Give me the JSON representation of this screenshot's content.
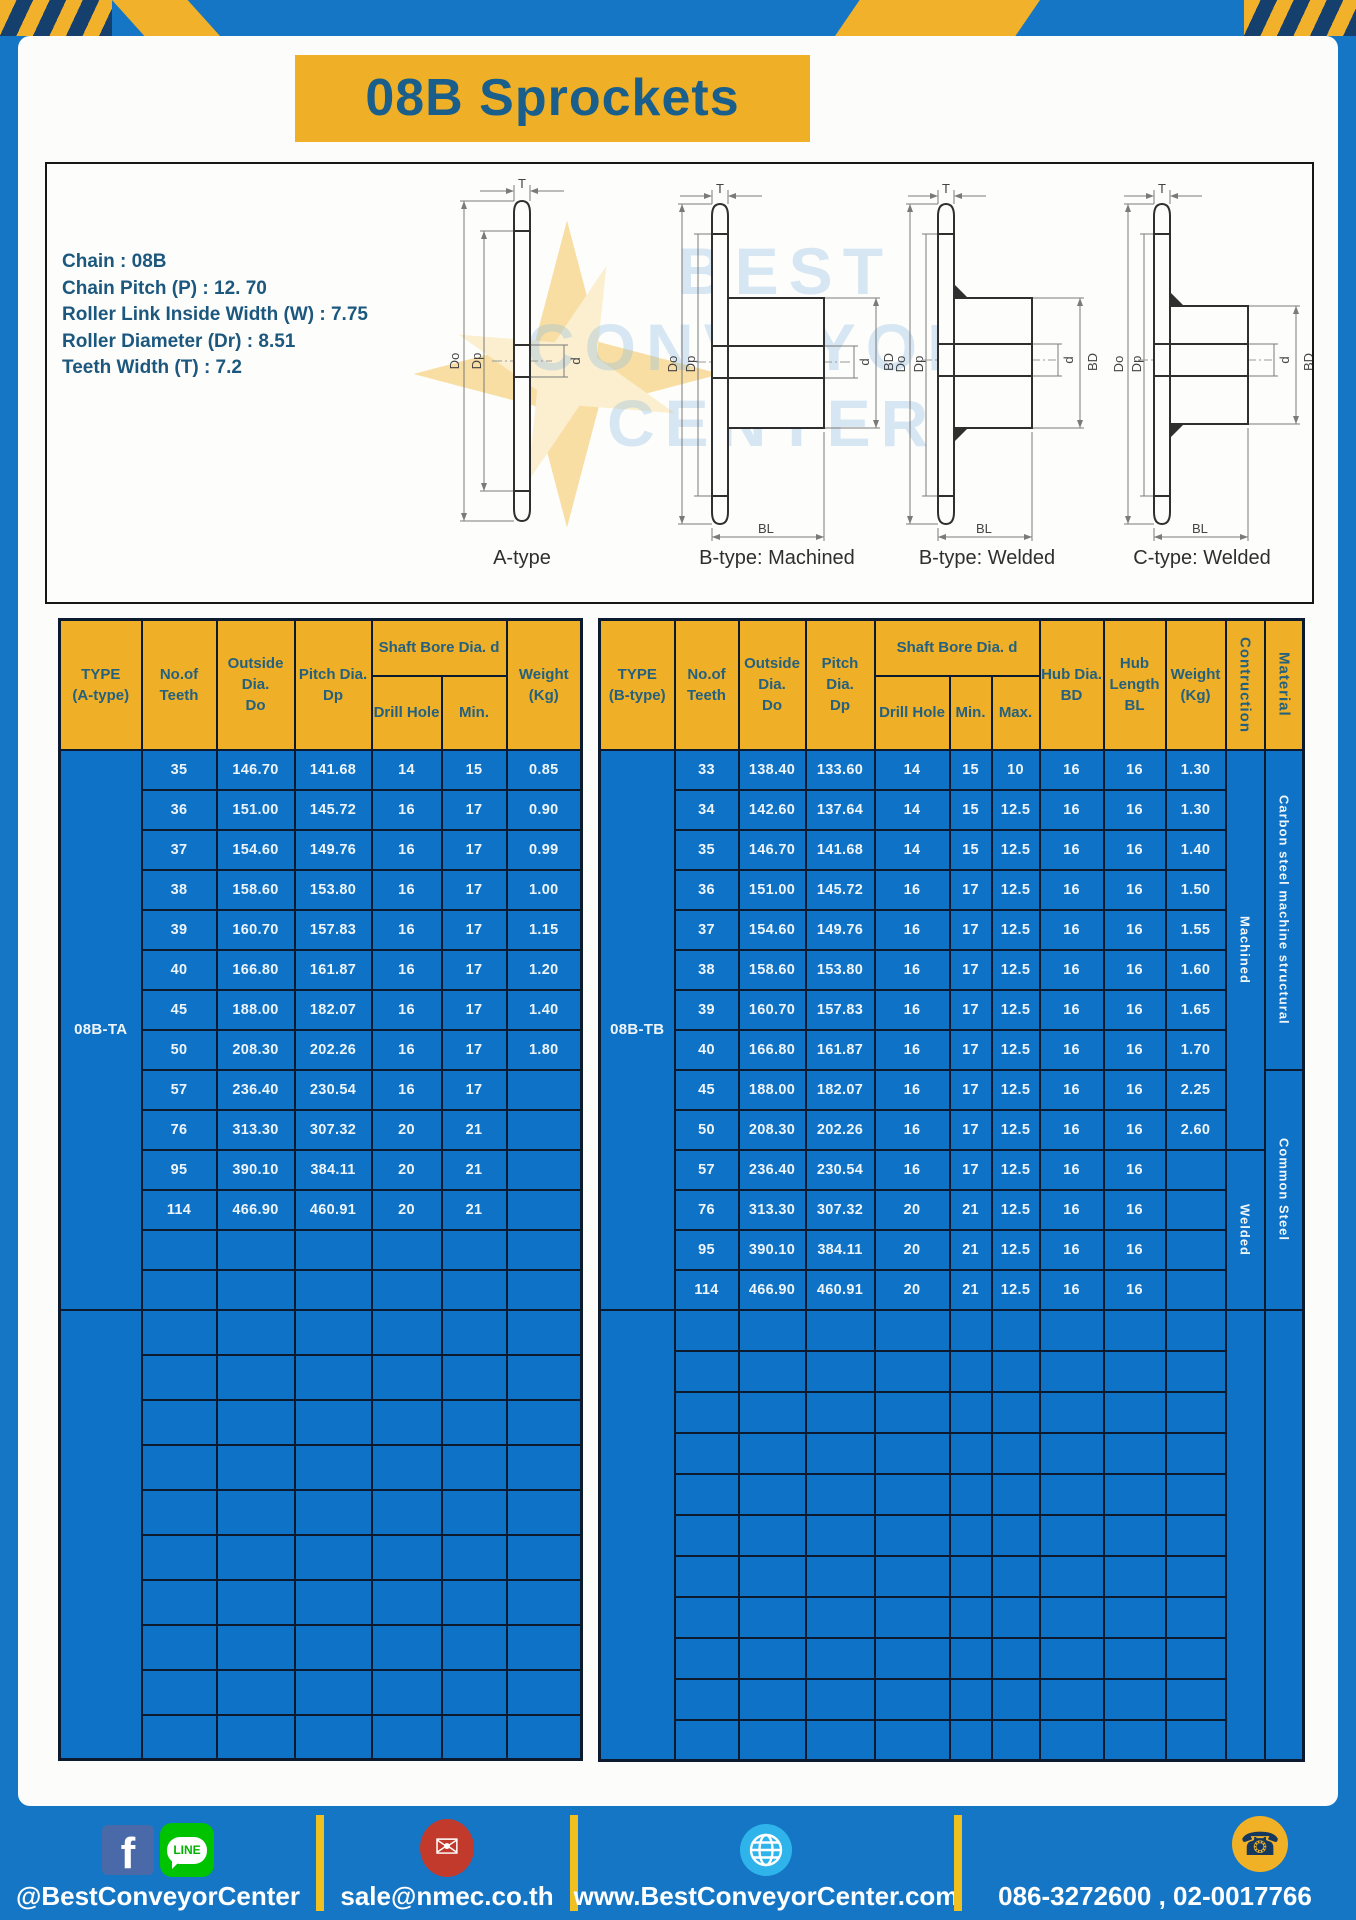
{
  "title": "08B Sprockets",
  "specs": [
    "Chain : 08B",
    "Chain Pitch (P) : 12. 70",
    "Roller Link Inside Width (W) : 7.75",
    "Roller Diameter (Dr) : 8.51",
    "Teeth Width (T) : 7.2"
  ],
  "watermark": {
    "lines": [
      "BEST",
      "CONVEYOR",
      "CENTER"
    ]
  },
  "diagram": {
    "captions": [
      "A-type",
      "B-type: Machined",
      "B-type: Welded",
      "C-type: Welded"
    ],
    "dims": {
      "teeth_width": "T",
      "outer_dia": "Do",
      "pitch_dia": "Dp",
      "bore": "d",
      "hub_dia": "BD",
      "hub_length": "BL"
    }
  },
  "left_table": {
    "header": {
      "type": [
        "TYPE",
        "(A-type)"
      ],
      "teeth": [
        "No.of",
        "Teeth"
      ],
      "outside": [
        "Outside",
        "Dia.",
        "Do"
      ],
      "pitch": [
        "Pitch Dia.",
        "Dp"
      ],
      "shaft_bore": [
        "Shaft Bore Dia. d"
      ],
      "drill": [
        "Drill Hole"
      ],
      "min": [
        "Min."
      ],
      "weight": [
        "Weight",
        "(Kg)"
      ]
    },
    "type_label": "08B-TA",
    "rows": [
      [
        "35",
        "146.70",
        "141.68",
        "14",
        "15",
        "0.85"
      ],
      [
        "36",
        "151.00",
        "145.72",
        "16",
        "17",
        "0.90"
      ],
      [
        "37",
        "154.60",
        "149.76",
        "16",
        "17",
        "0.99"
      ],
      [
        "38",
        "158.60",
        "153.80",
        "16",
        "17",
        "1.00"
      ],
      [
        "39",
        "160.70",
        "157.83",
        "16",
        "17",
        "1.15"
      ],
      [
        "40",
        "166.80",
        "161.87",
        "16",
        "17",
        "1.20"
      ],
      [
        "45",
        "188.00",
        "182.07",
        "16",
        "17",
        "1.40"
      ],
      [
        "50",
        "208.30",
        "202.26",
        "16",
        "17",
        "1.80"
      ],
      [
        "57",
        "236.40",
        "230.54",
        "16",
        "17",
        ""
      ],
      [
        "76",
        "313.30",
        "307.32",
        "20",
        "21",
        ""
      ],
      [
        "95",
        "390.10",
        "384.11",
        "20",
        "21",
        ""
      ],
      [
        "114",
        "466.90",
        "460.91",
        "20",
        "21",
        ""
      ]
    ],
    "empty_rows_group1": 2,
    "empty_rows_group2": 10
  },
  "right_table": {
    "header": {
      "type": [
        "TYPE",
        "(B-type)"
      ],
      "teeth": [
        "No.of",
        "Teeth"
      ],
      "outside": [
        "Outside",
        "Dia.",
        "Do"
      ],
      "pitch": [
        "Pitch Dia.",
        "Dp"
      ],
      "shaft_bore": [
        "Shaft Bore Dia. d"
      ],
      "drill": [
        "Drill Hole"
      ],
      "min": [
        "Min."
      ],
      "max": [
        "Max."
      ],
      "hub_dia": [
        "Hub Dia.",
        "BD"
      ],
      "hub_length": [
        "Hub",
        "Length",
        "BL"
      ],
      "weight": [
        "Weight",
        "(Kg)"
      ],
      "construction": [
        "Contruction"
      ],
      "material": [
        "Material"
      ]
    },
    "type_label": "08B-TB",
    "rows": [
      [
        "33",
        "138.40",
        "133.60",
        "14",
        "15",
        "10",
        "16",
        "16",
        "1.30"
      ],
      [
        "34",
        "142.60",
        "137.64",
        "14",
        "15",
        "12.5",
        "16",
        "16",
        "1.30"
      ],
      [
        "35",
        "146.70",
        "141.68",
        "14",
        "15",
        "12.5",
        "16",
        "16",
        "1.40"
      ],
      [
        "36",
        "151.00",
        "145.72",
        "16",
        "17",
        "12.5",
        "16",
        "16",
        "1.50"
      ],
      [
        "37",
        "154.60",
        "149.76",
        "16",
        "17",
        "12.5",
        "16",
        "16",
        "1.55"
      ],
      [
        "38",
        "158.60",
        "153.80",
        "16",
        "17",
        "12.5",
        "16",
        "16",
        "1.60"
      ],
      [
        "39",
        "160.70",
        "157.83",
        "16",
        "17",
        "12.5",
        "16",
        "16",
        "1.65"
      ],
      [
        "40",
        "166.80",
        "161.87",
        "16",
        "17",
        "12.5",
        "16",
        "16",
        "1.70"
      ],
      [
        "45",
        "188.00",
        "182.07",
        "16",
        "17",
        "12.5",
        "16",
        "16",
        "2.25"
      ],
      [
        "50",
        "208.30",
        "202.26",
        "16",
        "17",
        "12.5",
        "16",
        "16",
        "2.60"
      ],
      [
        "57",
        "236.40",
        "230.54",
        "16",
        "17",
        "12.5",
        "16",
        "16",
        ""
      ],
      [
        "76",
        "313.30",
        "307.32",
        "20",
        "21",
        "12.5",
        "16",
        "16",
        ""
      ],
      [
        "95",
        "390.10",
        "384.11",
        "20",
        "21",
        "12.5",
        "16",
        "16",
        ""
      ],
      [
        "114",
        "466.90",
        "460.91",
        "20",
        "21",
        "12.5",
        "16",
        "16",
        ""
      ]
    ],
    "construction_groups": [
      {
        "label": "Machined",
        "start": 0,
        "rows": 10
      },
      {
        "label": "Welded",
        "start": 10,
        "rows": 4
      }
    ],
    "material_groups": [
      {
        "label": "Carbon steel  machine  structural",
        "start": 0,
        "rows": 8
      },
      {
        "label": "Common Steel",
        "start": 8,
        "rows": 6
      }
    ],
    "empty_rows": 11
  },
  "footer": {
    "social": "@BestConveyorCenter",
    "email": "sale@nmec.co.th",
    "website": "www.BestConveyorCenter.com",
    "phone": "086-3272600 , 02-0017766"
  },
  "icons": {
    "facebook": "f",
    "line": "LINE",
    "email": "✉",
    "phone": "☎"
  },
  "colors": {
    "brand_blue": "#1576c5",
    "cell_blue": "#0e72c6",
    "gold": "#efaf26",
    "header_text": "#24607f",
    "table_border": "#0c1a30",
    "title_text": "#1a5f8b",
    "footer_divider": "#f0c020"
  }
}
